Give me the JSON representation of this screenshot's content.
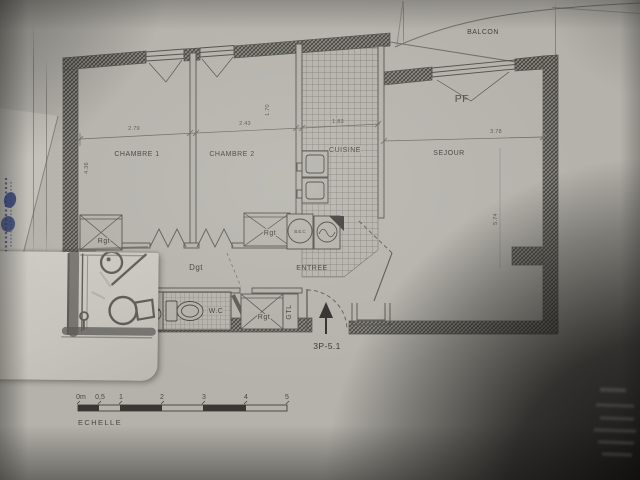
{
  "plan": {
    "unit_label": "3P-5.1",
    "rooms": {
      "chambre1": "CHAMBRE 1",
      "chambre2": "CHAMBRE 2",
      "cuisine": "CUISINE",
      "sejour": "SEJOUR",
      "balcon": "BALCON",
      "entree": "ENTREE",
      "wc": "W.C",
      "degagement": "Dgt"
    },
    "annotations": {
      "pf": "PF",
      "rgt": "Rgt",
      "gtl": "GTL",
      "bec": "B.E.C"
    },
    "dimensions": {
      "chambre1_width": "2.79",
      "chambre2_width": "2.43",
      "cuisine_width": "1.83",
      "sejour_width": "3.78",
      "left_depth": "4.36",
      "mid_depth": "1.70",
      "sejour_depth": "5.74"
    },
    "scale": {
      "label": "ECHELLE",
      "ticks": [
        "0m",
        "0,5",
        "1",
        "2",
        "3",
        "4",
        "5"
      ]
    }
  },
  "colors": {
    "paper": "#b2b0a9",
    "overlay_paper": "#cbc9c1",
    "ink": "#4a4845",
    "pencil": "#4b4845",
    "accent_blue": "#2e3d7e"
  }
}
